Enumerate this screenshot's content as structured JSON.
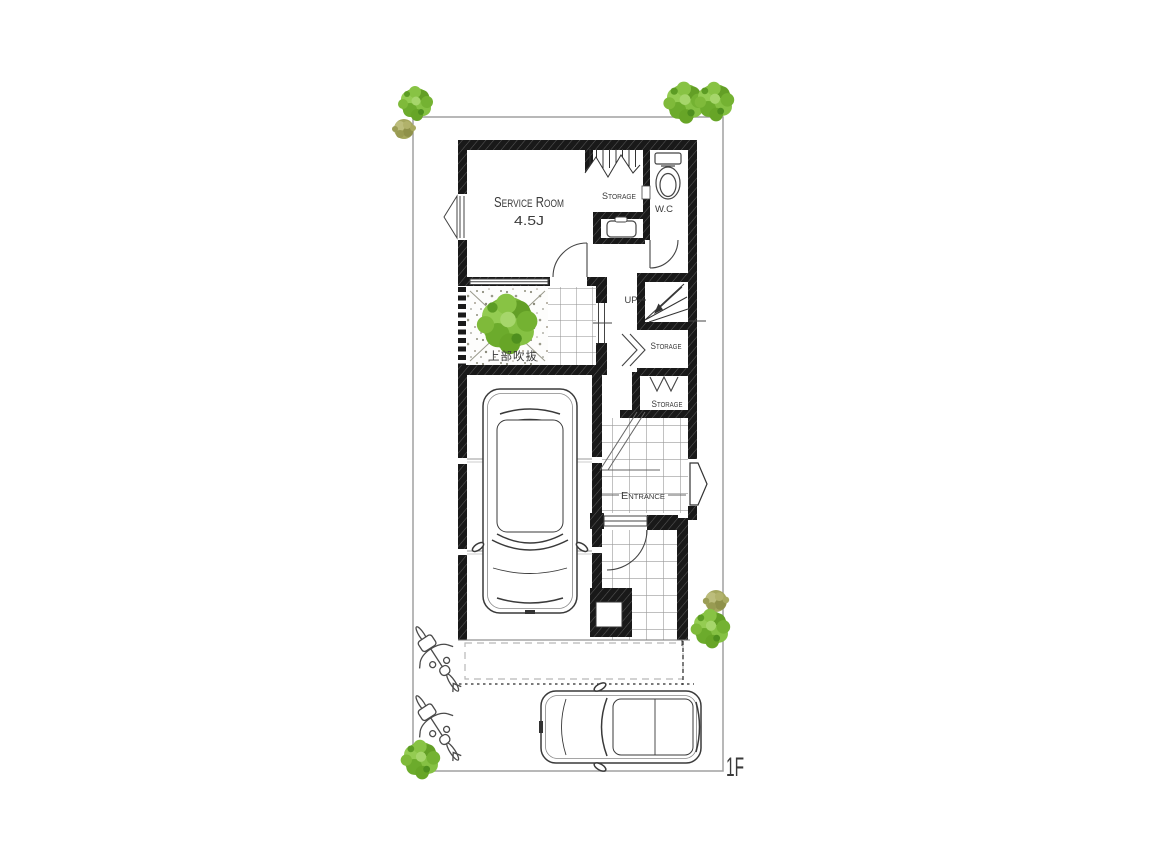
{
  "floor_plan": {
    "floor_label": "1F",
    "rooms": {
      "service_room": {
        "label": "Service Room",
        "size": "4.5J"
      },
      "storage_under_stairs": {
        "label": "Storage"
      },
      "wc": {
        "label": "W.C"
      },
      "stairs": {
        "label": "UP"
      },
      "storage_hall": {
        "label": "Storage"
      },
      "storage_entrance": {
        "label": "Storage"
      },
      "entrance": {
        "label": "Entrance"
      },
      "void_garden": {
        "label": "上部吹抜"
      }
    },
    "colors": {
      "wall": "#1a1a1a",
      "grid_line": "#999999",
      "text": "#3a3a3a",
      "tree_green": "#7ab637",
      "tree_olive": "#a5a75e",
      "boundary": "#a0a0a0"
    }
  }
}
